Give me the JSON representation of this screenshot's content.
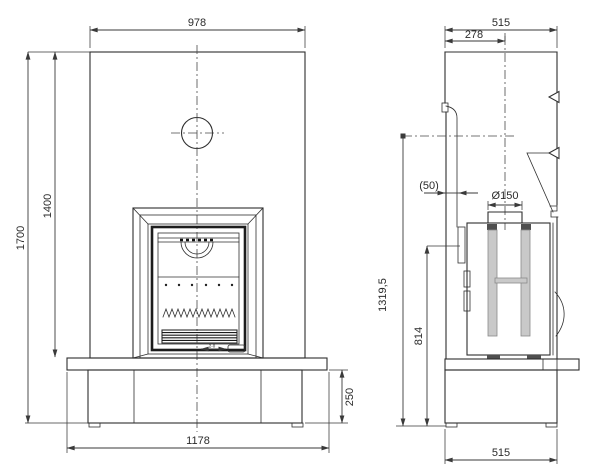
{
  "front": {
    "width_top": "978",
    "height_total": "1700",
    "height_opening": "1400",
    "base_height": "250",
    "base_width": "1178",
    "door_detail": "2-0"
  },
  "side": {
    "depth_top": "515",
    "flue_offset": "278",
    "clearance": "(50)",
    "flue_diameter": "Ø150",
    "flue_height": "1319,5",
    "body_height": "814",
    "base_depth": "515"
  },
  "colors": {
    "line": "#2f2f2f",
    "dimension": "#3a3a3a",
    "fill_light": "#c9c9c9",
    "fill_dark": "#4f4f4f",
    "background": "#ffffff"
  }
}
